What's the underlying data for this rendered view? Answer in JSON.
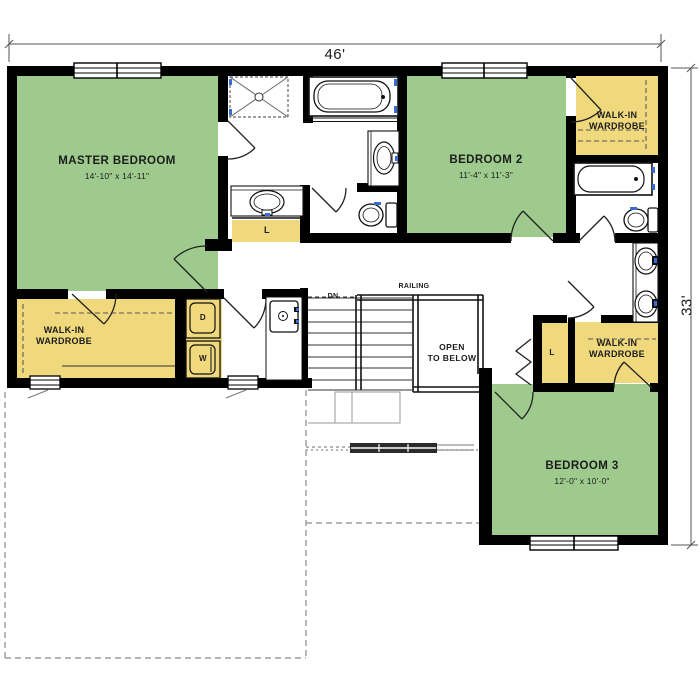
{
  "labels": {
    "master_bedroom": {
      "name": "MASTER BEDROOM",
      "size": "14'-10\" x 14'-11\""
    },
    "bedroom_2": {
      "name": "BEDROOM 2",
      "size": "11'-4\" x 11'-3\""
    },
    "bedroom_3": {
      "name": "BEDROOM 3",
      "size": "12'-0\" x 10'-0\""
    },
    "wardrobe_master": {
      "line1": "WALK-IN",
      "line2": "WARDROBE"
    },
    "wardrobe_bedroom2": {
      "line1": "WALK-IN",
      "line2": "WARDROBE"
    },
    "wardrobe_bedroom3": {
      "line1": "WALK-IN",
      "line2": "WARDROBE"
    },
    "linen_master_bath": "L",
    "linen_hall": "L",
    "dryer": "D",
    "washer": "W",
    "stairs": {
      "dn": "DN",
      "railing": "RAILING",
      "open1": "OPEN",
      "open2": "TO BELOW"
    },
    "dimensions": {
      "width": "46'",
      "depth": "33'"
    }
  },
  "colors": {
    "room_green": "#9ecb8d",
    "closet_yellow": "#f0d97d",
    "wall_black": "#000000",
    "fixture_blue": "#3a6ad4",
    "below_floor_gray": "#8a8a8a"
  }
}
